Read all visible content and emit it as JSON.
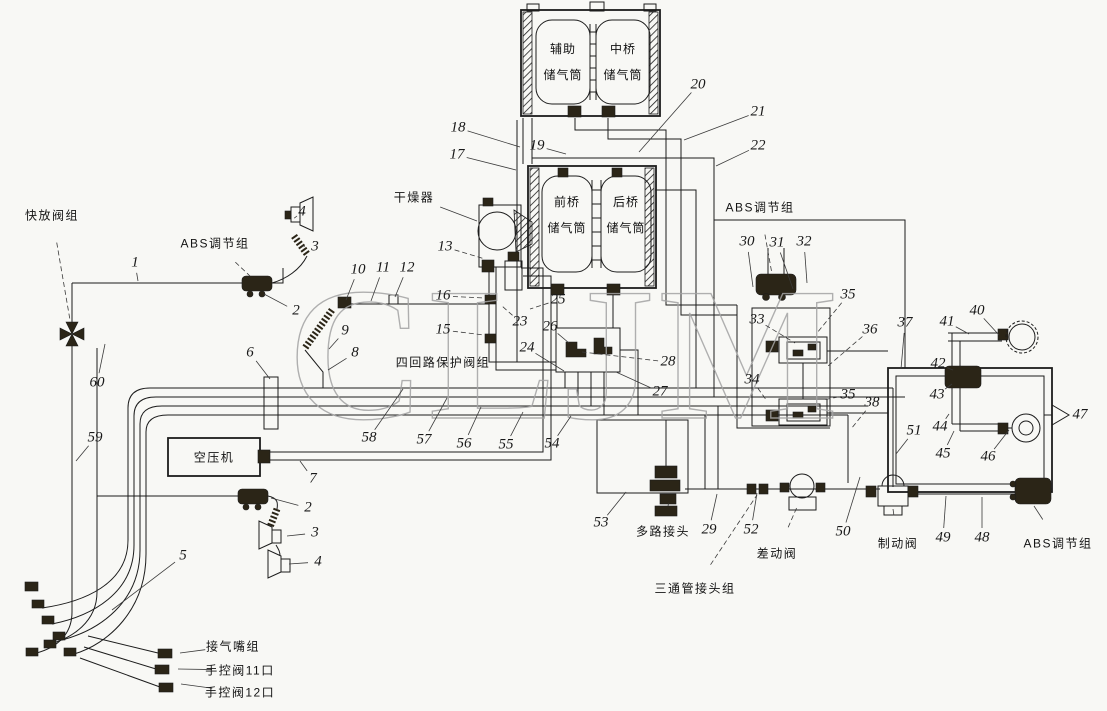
{
  "watermark": "CLJM",
  "colors": {
    "background": "#f8f8f5",
    "line": "#1c1c1c",
    "dark_component": "#2b2517",
    "watermark": "#a3a3a3"
  },
  "tanks": {
    "top_left": "辅助\n储气筒",
    "top_right": "中桥\n储气筒",
    "mid_left": "前桥\n储气筒",
    "mid_right": "后桥\n储气筒"
  },
  "component_labels": [
    {
      "text": "快放阀组",
      "x": 52,
      "y": 215,
      "tx": 70,
      "ty": 320,
      "dash": true
    },
    {
      "text": "ABS调节组",
      "x": 215,
      "y": 243,
      "tx": 250,
      "ty": 276,
      "dash": true
    },
    {
      "text": "干燥器",
      "x": 414,
      "y": 197,
      "tx": 477,
      "ty": 221,
      "dash": false
    },
    {
      "text": "四回路保护阀组",
      "x": 443,
      "y": 362
    },
    {
      "text": "空压机",
      "x": 214,
      "y": 457
    },
    {
      "text": "ABS调节组",
      "x": 760,
      "y": 207,
      "tx": 772,
      "ty": 274,
      "dash": true
    },
    {
      "text": "多路接头",
      "x": 663,
      "y": 531,
      "tx": 668,
      "ty": 506,
      "dash": true
    },
    {
      "text": "差动阀",
      "x": 777,
      "y": 553,
      "tx": 797,
      "ty": 507,
      "dash": true
    },
    {
      "text": "三通管接头组",
      "x": 695,
      "y": 588,
      "tx": 757,
      "ty": 495,
      "dash": true
    },
    {
      "text": "制动阀",
      "x": 898,
      "y": 543,
      "tx": 893,
      "ty": 509,
      "dash": false
    },
    {
      "text": "ABS调节组",
      "x": 1058,
      "y": 543,
      "tx": 1034,
      "ty": 506,
      "dash": false
    },
    {
      "text": "接气嘴组",
      "x": 233,
      "y": 646,
      "tx": 180,
      "ty": 653,
      "dash": false
    },
    {
      "text": "手控阀11口",
      "x": 240,
      "y": 670,
      "tx": 178,
      "ty": 669,
      "dash": false
    },
    {
      "text": "手控阀12口",
      "x": 240,
      "y": 692,
      "tx": 181,
      "ty": 684,
      "dash": false
    }
  ],
  "callouts": [
    {
      "n": "1",
      "x": 135,
      "y": 263,
      "tx": 138,
      "ty": 281
    },
    {
      "n": "2",
      "x": 296,
      "y": 311,
      "tx": 264,
      "ty": 294
    },
    {
      "n": "3",
      "x": 315,
      "y": 247,
      "tx": 302,
      "ty": 246
    },
    {
      "n": "4",
      "x": 302,
      "y": 212,
      "tx": 297,
      "ty": 216
    },
    {
      "n": "2",
      "x": 308,
      "y": 508,
      "tx": 271,
      "ty": 498
    },
    {
      "n": "3",
      "x": 315,
      "y": 533,
      "tx": 287,
      "ty": 536
    },
    {
      "n": "4",
      "x": 318,
      "y": 562,
      "tx": 289,
      "ty": 564
    },
    {
      "n": "5",
      "x": 183,
      "y": 556,
      "tx": 112,
      "ty": 610
    },
    {
      "n": "6",
      "x": 250,
      "y": 353,
      "tx": 270,
      "ty": 379
    },
    {
      "n": "7",
      "x": 313,
      "y": 479,
      "tx": 300,
      "ty": 461
    },
    {
      "n": "8",
      "x": 355,
      "y": 353,
      "tx": 328,
      "ty": 370
    },
    {
      "n": "9",
      "x": 345,
      "y": 331,
      "tx": 329,
      "ty": 349
    },
    {
      "n": "10",
      "x": 358,
      "y": 270,
      "tx": 346,
      "ty": 300
    },
    {
      "n": "11",
      "x": 383,
      "y": 268,
      "tx": 371,
      "ty": 301
    },
    {
      "n": "12",
      "x": 407,
      "y": 268,
      "tx": 395,
      "ty": 297
    },
    {
      "n": "13",
      "x": 445,
      "y": 247,
      "tx": 485,
      "ty": 259,
      "dash": true
    },
    {
      "n": "15",
      "x": 443,
      "y": 330,
      "tx": 484,
      "ty": 335,
      "dash": true
    },
    {
      "n": "16",
      "x": 443,
      "y": 296,
      "tx": 484,
      "ty": 298,
      "dash": true
    },
    {
      "n": "17",
      "x": 457,
      "y": 155,
      "tx": 516,
      "ty": 170
    },
    {
      "n": "18",
      "x": 458,
      "y": 128,
      "tx": 520,
      "ty": 147
    },
    {
      "n": "19",
      "x": 537,
      "y": 146,
      "tx": 566,
      "ty": 154
    },
    {
      "n": "20",
      "x": 698,
      "y": 85,
      "tx": 639,
      "ty": 152
    },
    {
      "n": "21",
      "x": 758,
      "y": 112,
      "tx": 684,
      "ty": 140
    },
    {
      "n": "22",
      "x": 758,
      "y": 146,
      "tx": 716,
      "ty": 166
    },
    {
      "n": "23",
      "x": 520,
      "y": 322,
      "tx": 502,
      "ty": 306,
      "dash": true
    },
    {
      "n": "24",
      "x": 527,
      "y": 348,
      "tx": 564,
      "ty": 371
    },
    {
      "n": "25",
      "x": 558,
      "y": 300,
      "tx": 530,
      "ty": 309,
      "dash": true
    },
    {
      "n": "26",
      "x": 550,
      "y": 327,
      "tx": 569,
      "ty": 343
    },
    {
      "n": "27",
      "x": 660,
      "y": 392,
      "tx": 616,
      "ty": 372
    },
    {
      "n": "28",
      "x": 668,
      "y": 362,
      "tx": 582,
      "ty": 352,
      "dash": true
    },
    {
      "n": "29",
      "x": 709,
      "y": 530,
      "tx": 717,
      "ty": 494
    },
    {
      "n": "30",
      "x": 747,
      "y": 242,
      "tx": 753,
      "ty": 287
    },
    {
      "n": "31",
      "x": 777,
      "y": 243,
      "tx": 793,
      "ty": 289
    },
    {
      "n": "32",
      "x": 804,
      "y": 242,
      "tx": 807,
      "ty": 283
    },
    {
      "n": "33",
      "x": 757,
      "y": 320,
      "tx": 795,
      "ty": 343,
      "dash": true
    },
    {
      "n": "34",
      "x": 752,
      "y": 380,
      "tx": 767,
      "ty": 401,
      "dash": true
    },
    {
      "n": "35",
      "x": 848,
      "y": 295,
      "tx": 817,
      "ty": 333,
      "dash": true
    },
    {
      "n": "36",
      "x": 870,
      "y": 330,
      "tx": 828,
      "ty": 366,
      "dash": true
    },
    {
      "n": "35",
      "x": 848,
      "y": 395,
      "tx": 823,
      "ty": 400,
      "dash": true
    },
    {
      "n": "38",
      "x": 872,
      "y": 403,
      "tx": 851,
      "ty": 429,
      "dash": true
    },
    {
      "n": "37",
      "x": 905,
      "y": 323,
      "tx": 901,
      "ty": 369
    },
    {
      "n": "40",
      "x": 977,
      "y": 311,
      "tx": 999,
      "ty": 335
    },
    {
      "n": "41",
      "x": 947,
      "y": 322,
      "tx": 969,
      "ty": 334
    },
    {
      "n": "42",
      "x": 938,
      "y": 364,
      "tx": 953,
      "ty": 370
    },
    {
      "n": "43",
      "x": 937,
      "y": 395,
      "tx": 952,
      "ty": 384
    },
    {
      "n": "44",
      "x": 940,
      "y": 427,
      "tx": 949,
      "ty": 414
    },
    {
      "n": "45",
      "x": 943,
      "y": 454,
      "tx": 954,
      "ty": 431
    },
    {
      "n": "46",
      "x": 988,
      "y": 457,
      "tx": 1009,
      "ty": 430
    },
    {
      "n": "47",
      "x": 1080,
      "y": 415
    },
    {
      "n": "48",
      "x": 982,
      "y": 538,
      "tx": 982,
      "ty": 497
    },
    {
      "n": "49",
      "x": 943,
      "y": 538,
      "tx": 946,
      "ty": 496
    },
    {
      "n": "50",
      "x": 843,
      "y": 532,
      "tx": 860,
      "ty": 477
    },
    {
      "n": "51",
      "x": 914,
      "y": 431,
      "tx": 896,
      "ty": 454
    },
    {
      "n": "52",
      "x": 751,
      "y": 530,
      "tx": 757,
      "ty": 493
    },
    {
      "n": "53",
      "x": 601,
      "y": 523,
      "tx": 626,
      "ty": 492
    },
    {
      "n": "54",
      "x": 552,
      "y": 444,
      "tx": 571,
      "ty": 416
    },
    {
      "n": "55",
      "x": 506,
      "y": 445,
      "tx": 523,
      "ty": 412
    },
    {
      "n": "56",
      "x": 464,
      "y": 444,
      "tx": 481,
      "ty": 407
    },
    {
      "n": "57",
      "x": 424,
      "y": 440,
      "tx": 447,
      "ty": 398
    },
    {
      "n": "58",
      "x": 369,
      "y": 438,
      "tx": 403,
      "ty": 389
    },
    {
      "n": "59",
      "x": 95,
      "y": 438,
      "tx": 76,
      "ty": 461
    },
    {
      "n": "60",
      "x": 97,
      "y": 383,
      "tx": 105,
      "ty": 344
    }
  ]
}
